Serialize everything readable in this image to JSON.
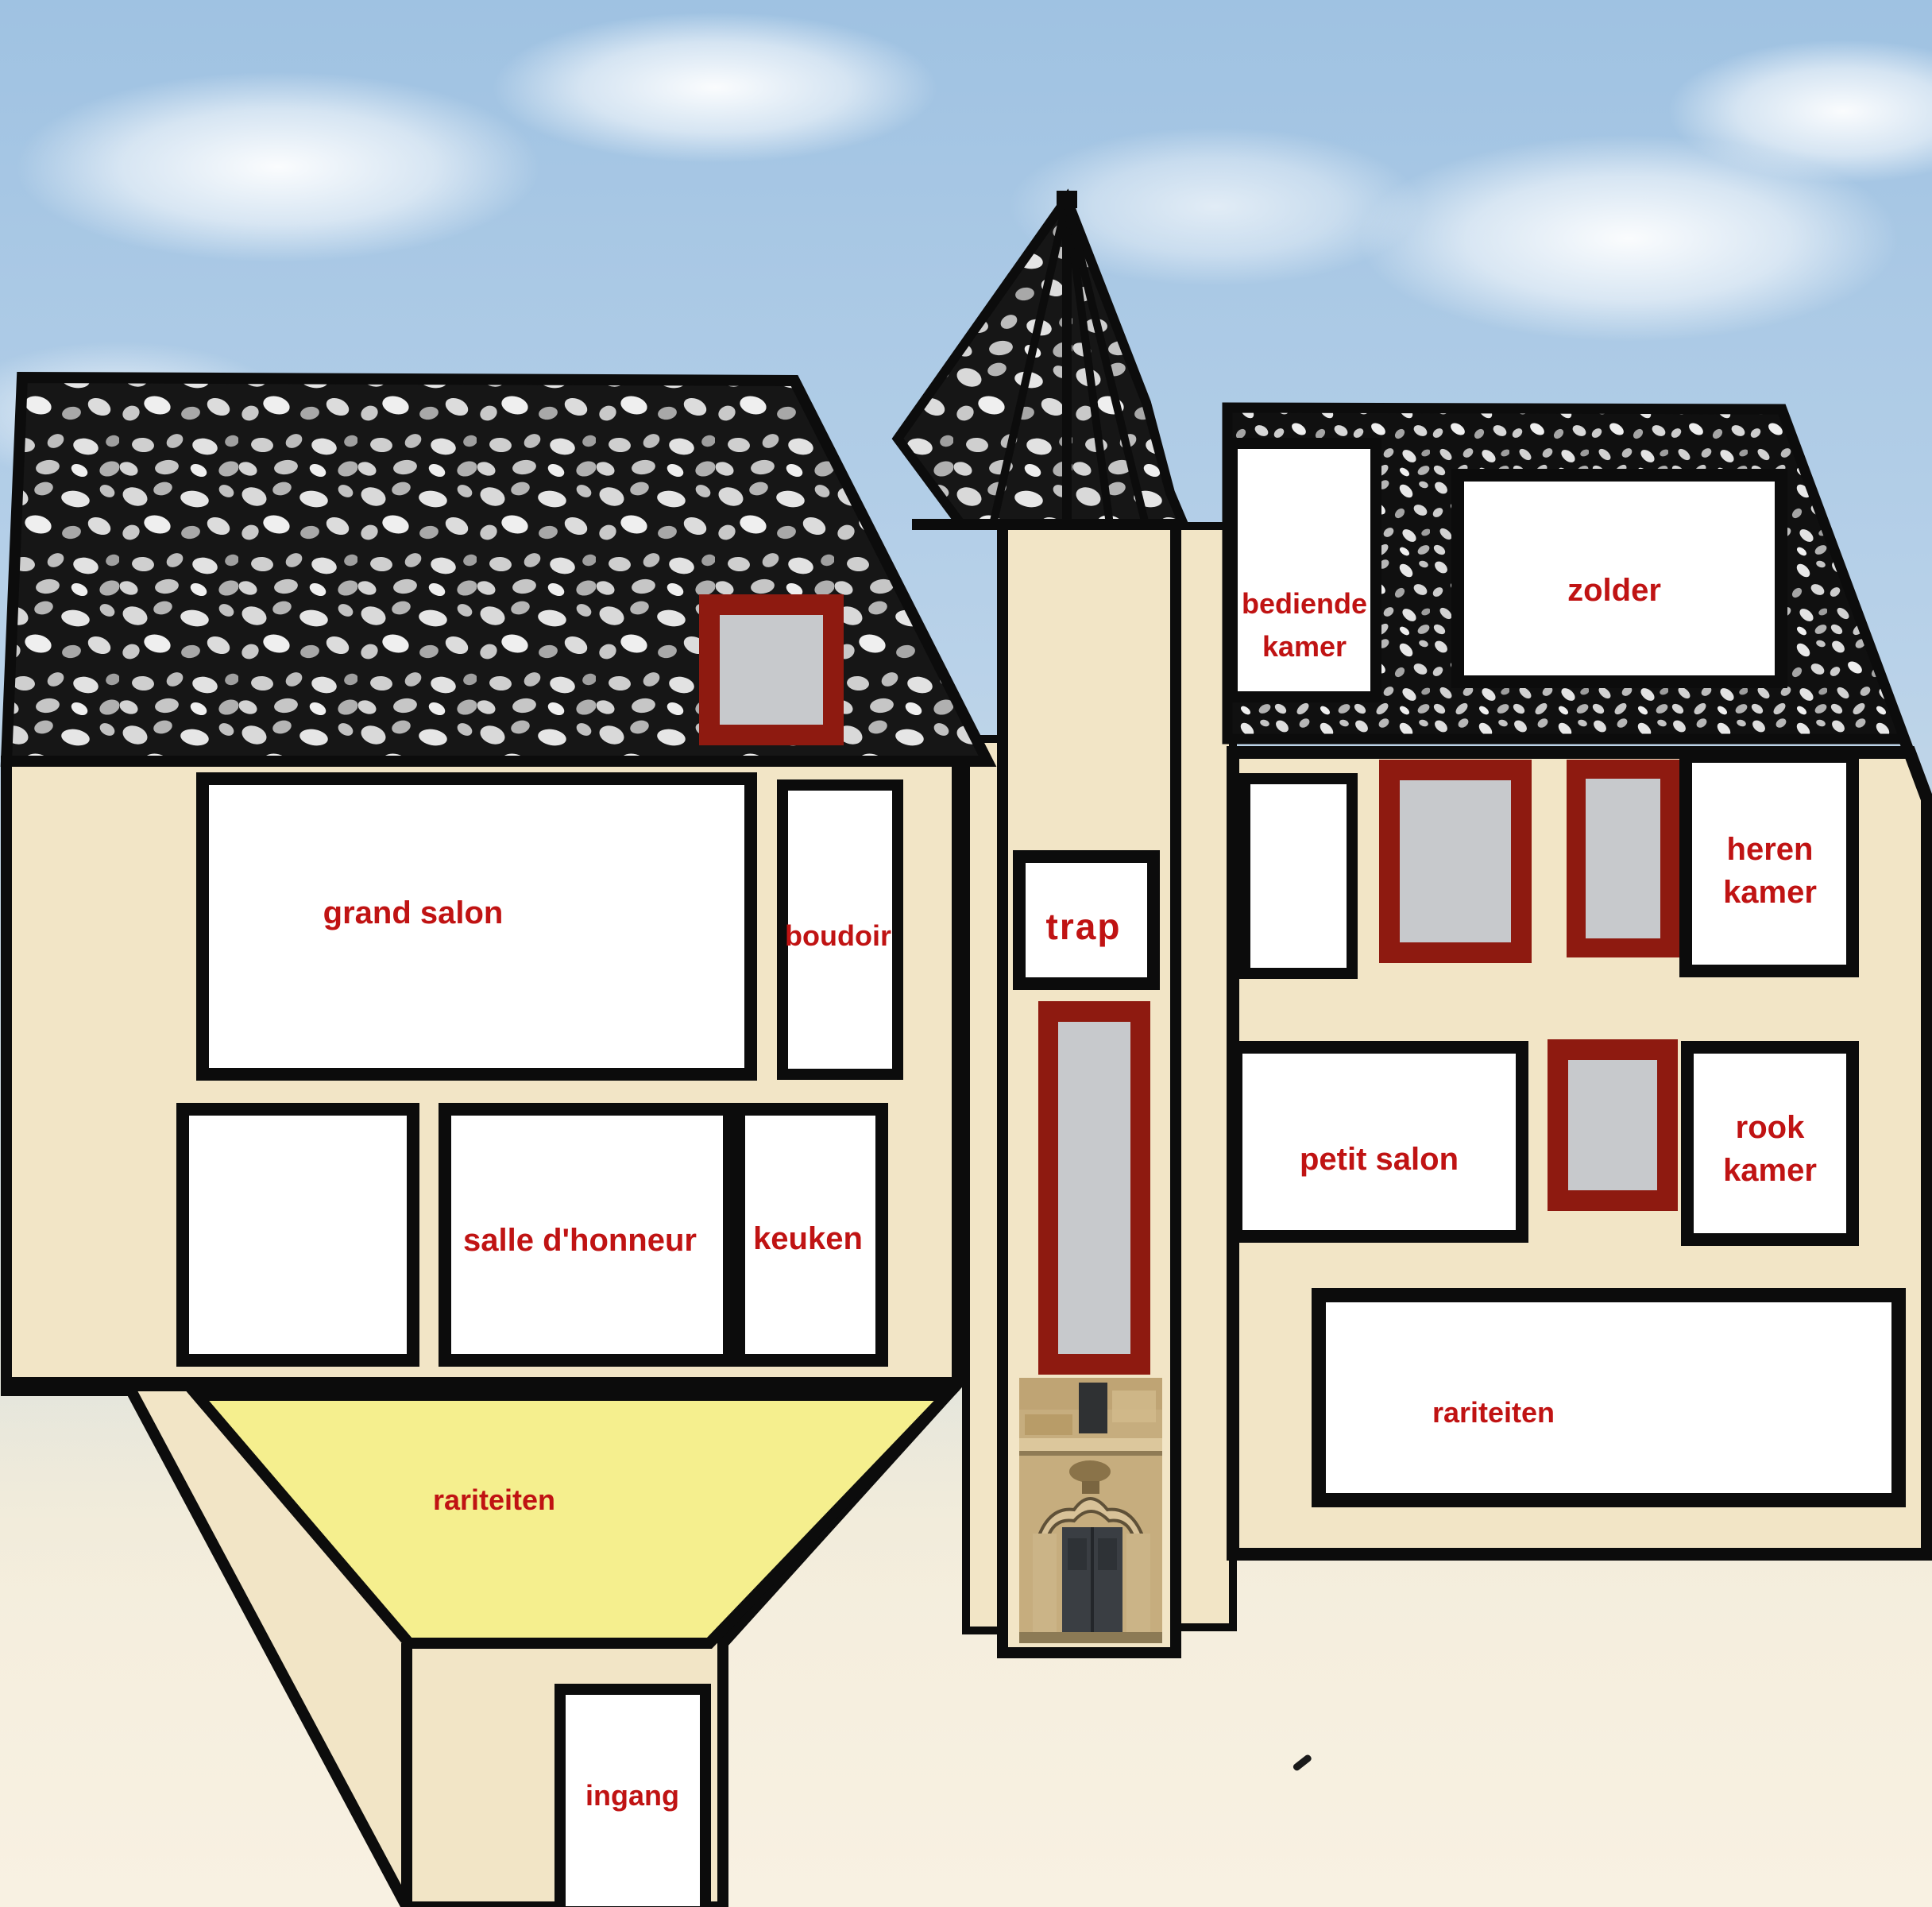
{
  "labels": {
    "grand_salon": "grand salon",
    "boudoir": "boudoir",
    "salle_dhonneur": "salle d'honneur",
    "keuken": "keuken",
    "rariteiten_left": "rariteiten",
    "ingang": "ingang",
    "trap": "trap",
    "bediende_line1": "bediende",
    "bediende_line2": "kamer",
    "zolder": "zolder",
    "heren_line1": "heren",
    "heren_line2": "kamer",
    "petit_salon": "petit salon",
    "rook_line1": "rook",
    "rook_line2": "kamer",
    "rariteiten_right": "rariteiten"
  },
  "colors": {
    "label_red": "#c01313",
    "wall_beige": "#f2e5c6",
    "wall_beige_light": "#f6ecd6",
    "rariteiten_yellow": "#f5ef8e",
    "window_frame_red": "#8e1a10",
    "window_gray": "#c7c9cc",
    "outline_black": "#0c0c0c",
    "room_white": "#ffffff",
    "sky_blue": "#a9c6e4",
    "ground_cream": "#f6efdf"
  }
}
